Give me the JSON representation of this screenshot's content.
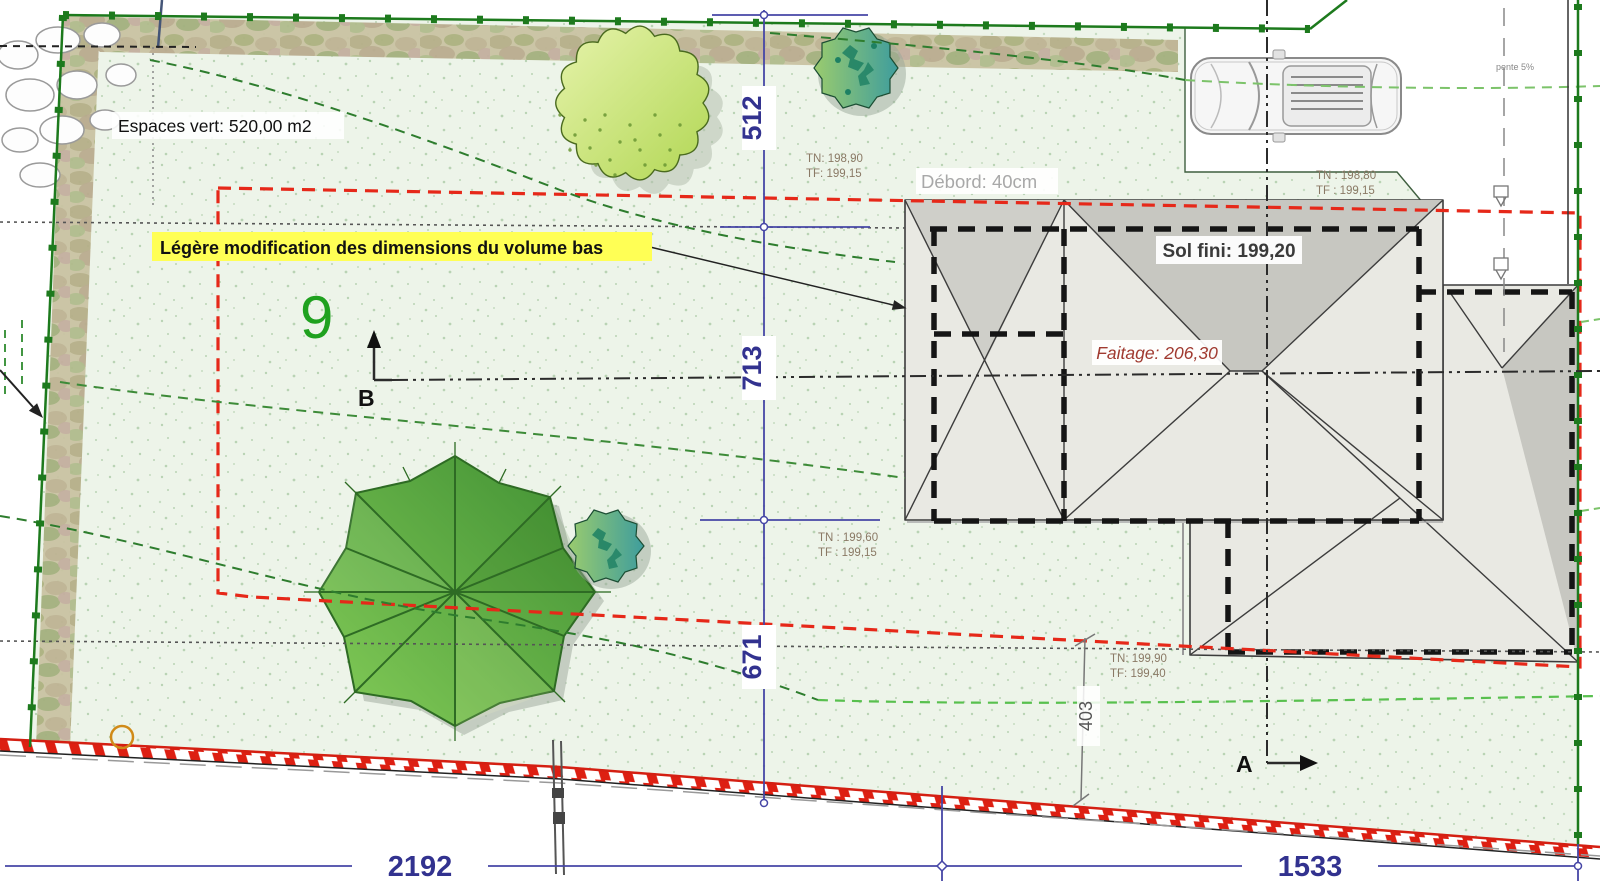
{
  "plan": {
    "green_area_label": "Espaces vert: 520,00 m2",
    "modification_note": "Légère modification des dimensions du volume bas",
    "parcel_number": "9",
    "slope_label": "pente 5%",
    "overhang_label": "Débord: 40cm"
  },
  "building": {
    "finished_floor_label": "Sol fini: 199,20",
    "ridge_label": "Faitage: 206,30"
  },
  "spot_levels": [
    {
      "tn": "TN: 198,90",
      "tf": "TF: 199,15"
    },
    {
      "tn": "TN : 198,80",
      "tf": "TF : 199,15"
    },
    {
      "tn": "TN : 199,60",
      "tf": "TF : 199,15"
    },
    {
      "tn": "TN: 199,90",
      "tf": "TF: 199,40"
    }
  ],
  "dimensions": {
    "top": "512",
    "middle": "713",
    "bottom": "671",
    "offset_right": "403",
    "frontage_left": "2192",
    "frontage_right": "1533"
  },
  "sections": {
    "a_label": "A",
    "b_label": "B"
  },
  "colors": {
    "boundary_green": "#1d7a1d",
    "setback_red": "#e62819",
    "dimension_blue": "#32328f",
    "highlight_yellow": "#ffff55",
    "roof_gray": "#e9e9e3",
    "grass_green": "#edf4e9"
  }
}
